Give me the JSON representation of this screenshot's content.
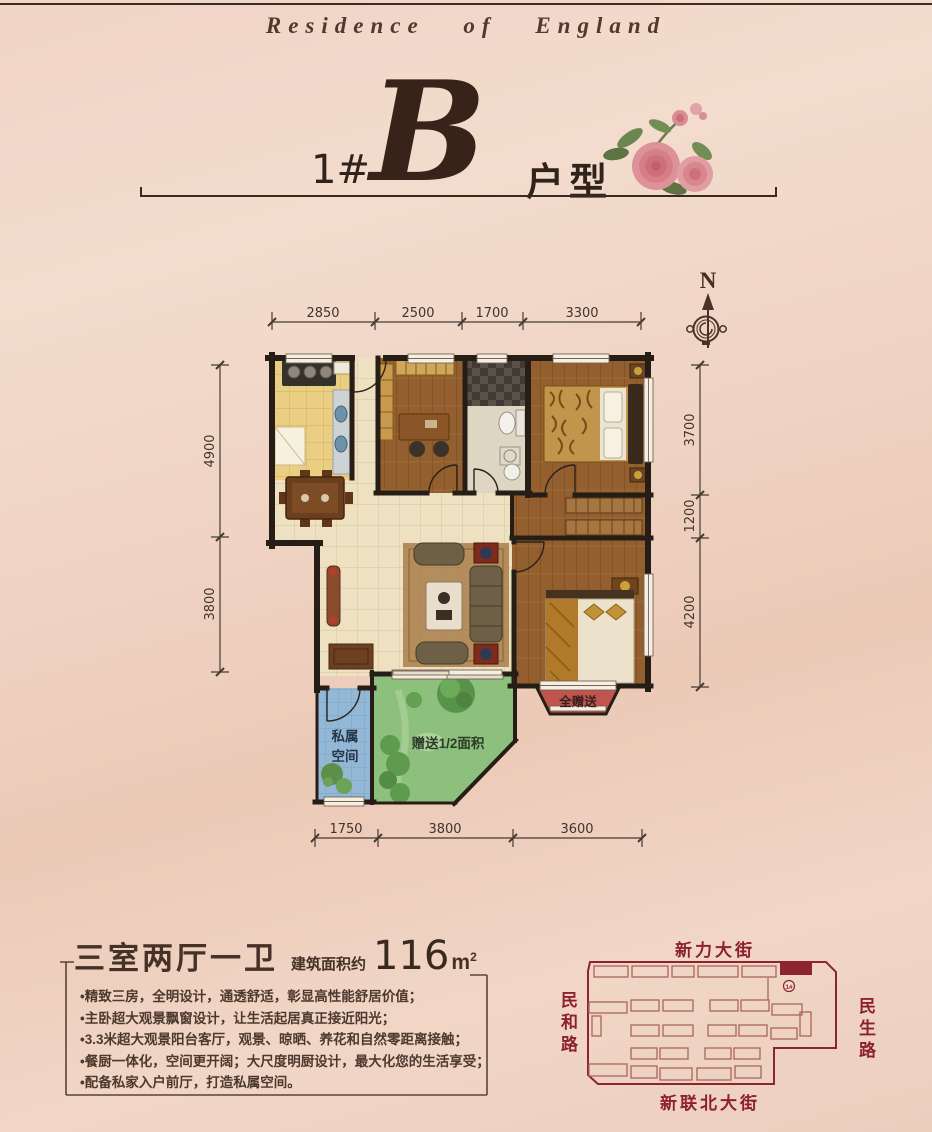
{
  "header": {
    "brand": "Residence of England"
  },
  "title": {
    "block": "1#",
    "letter": "B",
    "suffix": "户型"
  },
  "compass": {
    "north_label": "N"
  },
  "floor_plan": {
    "dim_top": [
      "2850",
      "2500",
      "1700",
      "3300"
    ],
    "dim_left": [
      "4900",
      "3800"
    ],
    "dim_right": [
      "3700",
      "1200",
      "4200"
    ],
    "dim_bottom": [
      "1750",
      "3800",
      "3600"
    ],
    "label_private_1": "私属",
    "label_private_2": "空间",
    "label_gift_half": "赠送1/2面积",
    "label_gift_full": "全赠送"
  },
  "summary": {
    "layout_title": "三室两厅一卫",
    "area_prefix": "建筑面积约",
    "area_value": "116",
    "area_unit": "m",
    "area_unit_sup": "2",
    "features": [
      "•精致三房，全明设计，通透舒适，彰显高性能舒居价值；",
      "•主卧超大观景飘窗设计，让生活起居真正接近阳光；",
      "•3.3米超大观景阳台客厅，观景、晾晒、养花和自然零距离接触；",
      "•餐厨一体化，空间更开阔；大尺度明厨设计，最大化您的生活享受；",
      "•配备私家入户前厅，打造私属空间。"
    ]
  },
  "site_map": {
    "street_top": "新力大街",
    "street_left": "民和路",
    "street_right": "民生路",
    "street_bottom": "新联北大街",
    "highlight_label": "1#"
  },
  "colors": {
    "accent_dark_red": "#8d212b",
    "wall": "#261e16",
    "text_dark": "#30231c",
    "gift_bay_red": "#c0544e",
    "garden_green": "#8cc07c",
    "private_blue": "#92b8d6"
  }
}
